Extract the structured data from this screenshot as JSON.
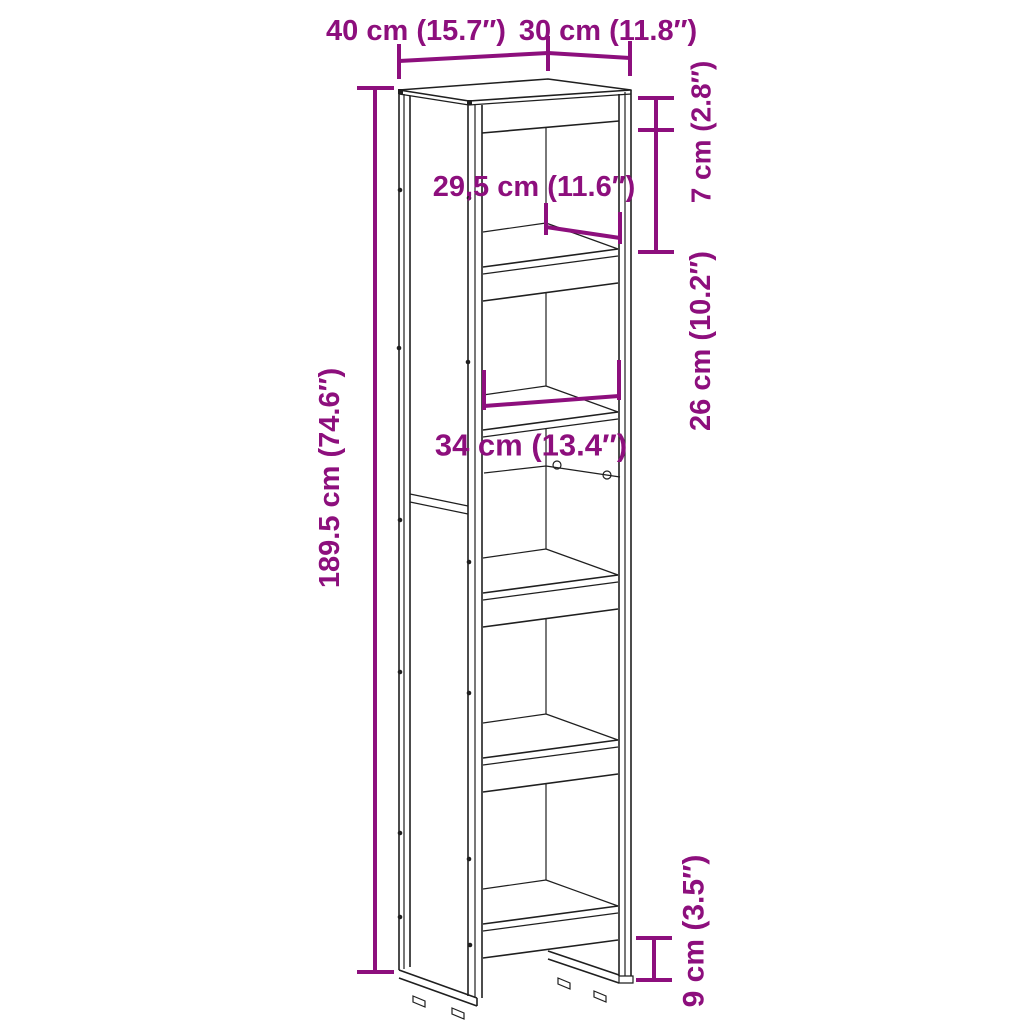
{
  "diagram": {
    "type": "furniture-dimension-diagram",
    "product": "tall narrow bookcase with 6 shelves on sled base",
    "accent_color": "#8D0F7D",
    "line_color": "#1f1f1f",
    "background": "#ffffff"
  },
  "labels": {
    "width": "40 cm (15.7″)",
    "depth": "30 cm (11.8″)",
    "top_section": "7 cm (2.8″)",
    "compartment": "26 cm (10.2″)",
    "inner_depth": "29,5 cm (11.6″)",
    "inner_width": "34 cm (13.4″)",
    "height": "189.5 cm (74.6″)",
    "clearance": "9 cm (3.5″)"
  }
}
